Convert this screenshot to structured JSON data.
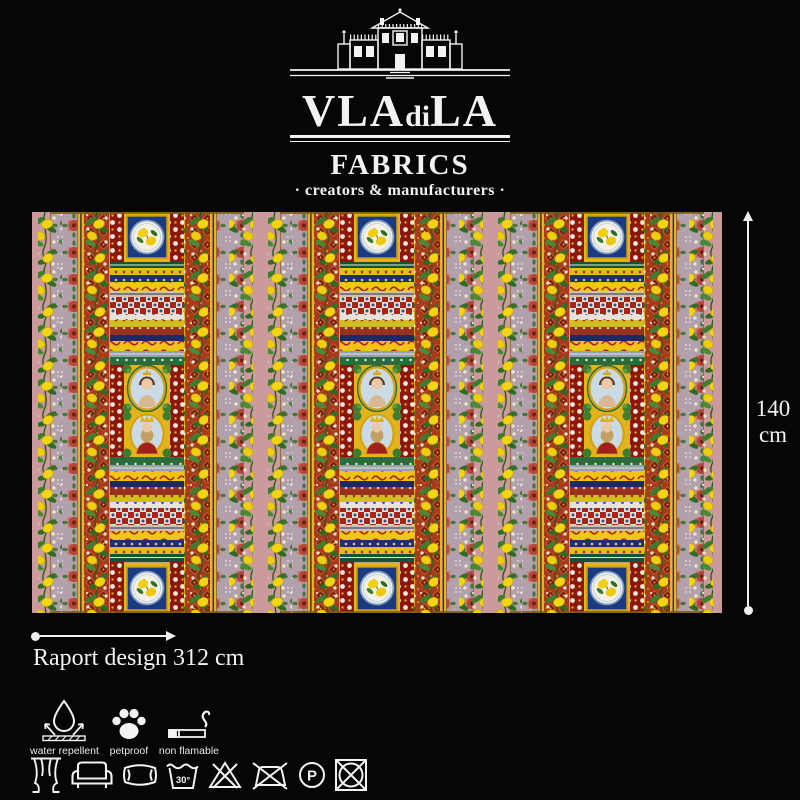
{
  "page": {
    "background": "#060606"
  },
  "logo": {
    "mansion_icon": "villa-mansion-icon",
    "brand": "VLAdiLA",
    "brand_parts": [
      "VLA",
      "di",
      "LA"
    ],
    "division": "FABRICS",
    "tagline": "· creators & manufacturers ·"
  },
  "fabric": {
    "description": "Sicilian baroque striped fabric with lemon garlands, rose borders, ornamental bands and portrait medallions, pattern repeated 3 times",
    "background_color": "#ca9a9c",
    "motifs": [
      "lemon-garland",
      "rose-border-stripe",
      "damask-stripe",
      "ornamental-band-stack",
      "lemon-medallion",
      "woman-portrait-medallion",
      "king-portrait-medallion"
    ]
  },
  "measurements": {
    "height_value": "140",
    "height_unit": "cm",
    "raport_label": "Raport design 312 cm"
  },
  "features": [
    {
      "label": "water repellent",
      "icon": "water-repellent-icon"
    },
    {
      "label": "petproof",
      "icon": "paw-icon"
    },
    {
      "label": "non flamable",
      "icon": "cigarette-icon"
    }
  ],
  "care_symbols": [
    {
      "name": "suitable-for-curtains",
      "icon": "curtains-icon"
    },
    {
      "name": "suitable-for-upholstery",
      "icon": "sofa-icon"
    },
    {
      "name": "suitable-for-cushions",
      "icon": "pillow-icon"
    },
    {
      "name": "machine-wash-30",
      "icon": "wash-tub-icon",
      "text": "30°"
    },
    {
      "name": "do-not-bleach",
      "icon": "crossed-triangle-icon"
    },
    {
      "name": "do-not-iron",
      "icon": "crossed-iron-icon"
    },
    {
      "name": "professional-dry-clean",
      "icon": "circle-p-icon",
      "text": "P"
    },
    {
      "name": "do-not-tumble-dry",
      "icon": "crossed-square-circle-icon"
    }
  ]
}
